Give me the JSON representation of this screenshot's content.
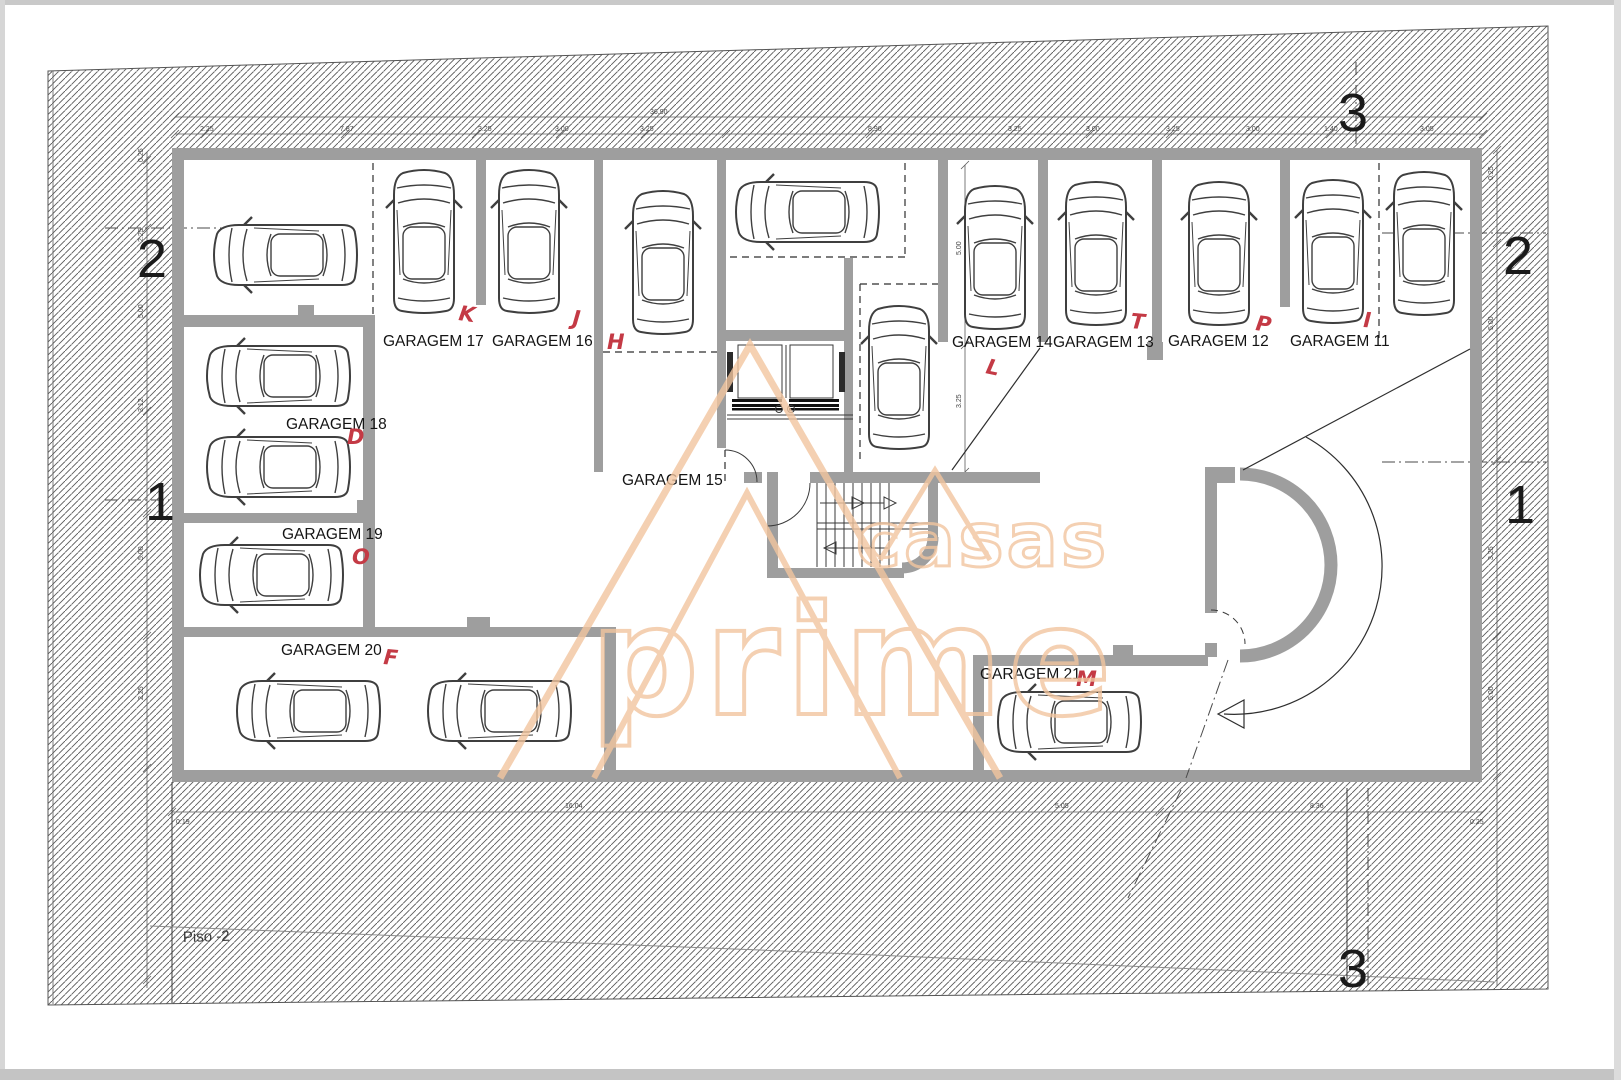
{
  "floor_label": "Piso -2",
  "watermark": {
    "word1": "casas",
    "word2": "prime",
    "color": "#f2c59f"
  },
  "garages": [
    {
      "label": "GARAGEM 17",
      "lx": 383,
      "ly": 346,
      "letter": "K",
      "tx": 458,
      "ty": 320,
      "rot": 8
    },
    {
      "label": "GARAGEM 16",
      "lx": 492,
      "ly": 346,
      "letter": "J",
      "tx": 572,
      "ty": 325,
      "rot": 5
    },
    {
      "label": "GARAGEM 15",
      "lx": 622,
      "ly": 485,
      "letter": "H",
      "tx": 607,
      "ty": 349,
      "rot": 0
    },
    {
      "label": "GARAGEM 14",
      "lx": 952,
      "ly": 347,
      "letter": "L",
      "tx": 985,
      "ty": 373,
      "rot": 12
    },
    {
      "label": "GARAGEM 13",
      "lx": 1053,
      "ly": 347,
      "letter": "T",
      "tx": 1130,
      "ty": 328,
      "rot": 5
    },
    {
      "label": "GARAGEM 12",
      "lx": 1168,
      "ly": 346,
      "letter": "P",
      "tx": 1255,
      "ty": 330,
      "rot": 8
    },
    {
      "label": "GARAGEM 11",
      "lx": 1290,
      "ly": 346,
      "letter": "I",
      "tx": 1363,
      "ty": 327,
      "rot": 3
    },
    {
      "label": "GARAGEM 18",
      "lx": 286,
      "ly": 429,
      "letter": "D",
      "tx": 347,
      "ty": 444,
      "rot": 0
    },
    {
      "label": "GARAGEM 19",
      "lx": 282,
      "ly": 539,
      "letter": "O",
      "tx": 352,
      "ty": 564,
      "rot": 0
    },
    {
      "label": "GARAGEM 20",
      "lx": 281,
      "ly": 655,
      "letter": "F",
      "tx": 383,
      "ty": 664,
      "rot": 5
    },
    {
      "label": "GARAGEM 21",
      "lx": 980,
      "ly": 679,
      "letter": "M",
      "tx": 1076,
      "ty": 686,
      "rot": 0
    }
  ],
  "cars": [
    {
      "x": 284,
      "y": 255,
      "rot": -90
    },
    {
      "x": 424,
      "y": 240,
      "rot": 0
    },
    {
      "x": 529,
      "y": 240,
      "rot": 0
    },
    {
      "x": 663,
      "y": 261,
      "rot": 0
    },
    {
      "x": 806,
      "y": 212,
      "rot": -90
    },
    {
      "x": 899,
      "y": 376,
      "rot": 0
    },
    {
      "x": 995,
      "y": 256,
      "rot": 0
    },
    {
      "x": 1096,
      "y": 252,
      "rot": 0
    },
    {
      "x": 1219,
      "y": 252,
      "rot": 0
    },
    {
      "x": 1333,
      "y": 250,
      "rot": 0
    },
    {
      "x": 1424,
      "y": 242,
      "rot": 0
    },
    {
      "x": 277,
      "y": 376,
      "rot": -90
    },
    {
      "x": 277,
      "y": 467,
      "rot": -90
    },
    {
      "x": 270,
      "y": 575,
      "rot": -90
    },
    {
      "x": 307,
      "y": 711,
      "rot": -90
    },
    {
      "x": 498,
      "y": 711,
      "rot": -90
    },
    {
      "x": 1068,
      "y": 722,
      "rot": -90
    }
  ],
  "section_markers": [
    {
      "n": "3",
      "x": 1338,
      "y": 131
    },
    {
      "n": "2",
      "x": 137,
      "y": 277
    },
    {
      "n": "2",
      "x": 1503,
      "y": 274
    },
    {
      "n": "1",
      "x": 145,
      "y": 520
    },
    {
      "n": "1",
      "x": 1505,
      "y": 523
    },
    {
      "n": "3",
      "x": 1338,
      "y": 987
    }
  ],
  "dimensions": {
    "top_overall": [
      {
        "t": "36.90",
        "x": 650,
        "y": 114
      }
    ],
    "top": [
      {
        "t": "2.25",
        "x": 200
      },
      {
        "t": "7.87",
        "x": 340
      },
      {
        "t": "3.25",
        "x": 478
      },
      {
        "t": "3.00",
        "x": 555
      },
      {
        "t": "3.25",
        "x": 640
      },
      {
        "t": "8.90",
        "x": 868
      },
      {
        "t": "3.25",
        "x": 1008
      },
      {
        "t": "3.00",
        "x": 1086
      },
      {
        "t": "3.25",
        "x": 1166
      },
      {
        "t": "3.00",
        "x": 1246
      },
      {
        "t": "1.40",
        "x": 1324
      },
      {
        "t": "3.05",
        "x": 1420
      }
    ],
    "bottom": [
      {
        "t": "16.04",
        "x": 565,
        "y": 808
      },
      {
        "t": "5.05",
        "x": 1055,
        "y": 808
      },
      {
        "t": "8.36",
        "x": 1310,
        "y": 808
      },
      {
        "t": "0.19",
        "x": 176,
        "y": 824
      },
      {
        "t": "0.25",
        "x": 1470,
        "y": 824
      }
    ],
    "left": [
      {
        "t": "0.25",
        "y": 162
      },
      {
        "t": "2.25",
        "y": 242
      },
      {
        "t": "5.00",
        "y": 318
      },
      {
        "t": "3.12",
        "y": 412
      },
      {
        "t": "5.00",
        "y": 560
      },
      {
        "t": "2.25",
        "y": 700
      }
    ],
    "right": [
      {
        "t": "0.25",
        "y": 180
      },
      {
        "t": "5.00",
        "y": 330
      },
      {
        "t": "3.25",
        "y": 560
      },
      {
        "t": "5.00",
        "y": 700
      }
    ],
    "interior": [
      {
        "t": "5.00",
        "x": 961,
        "y": 255
      },
      {
        "t": "3.25",
        "x": 961,
        "y": 408
      }
    ]
  }
}
